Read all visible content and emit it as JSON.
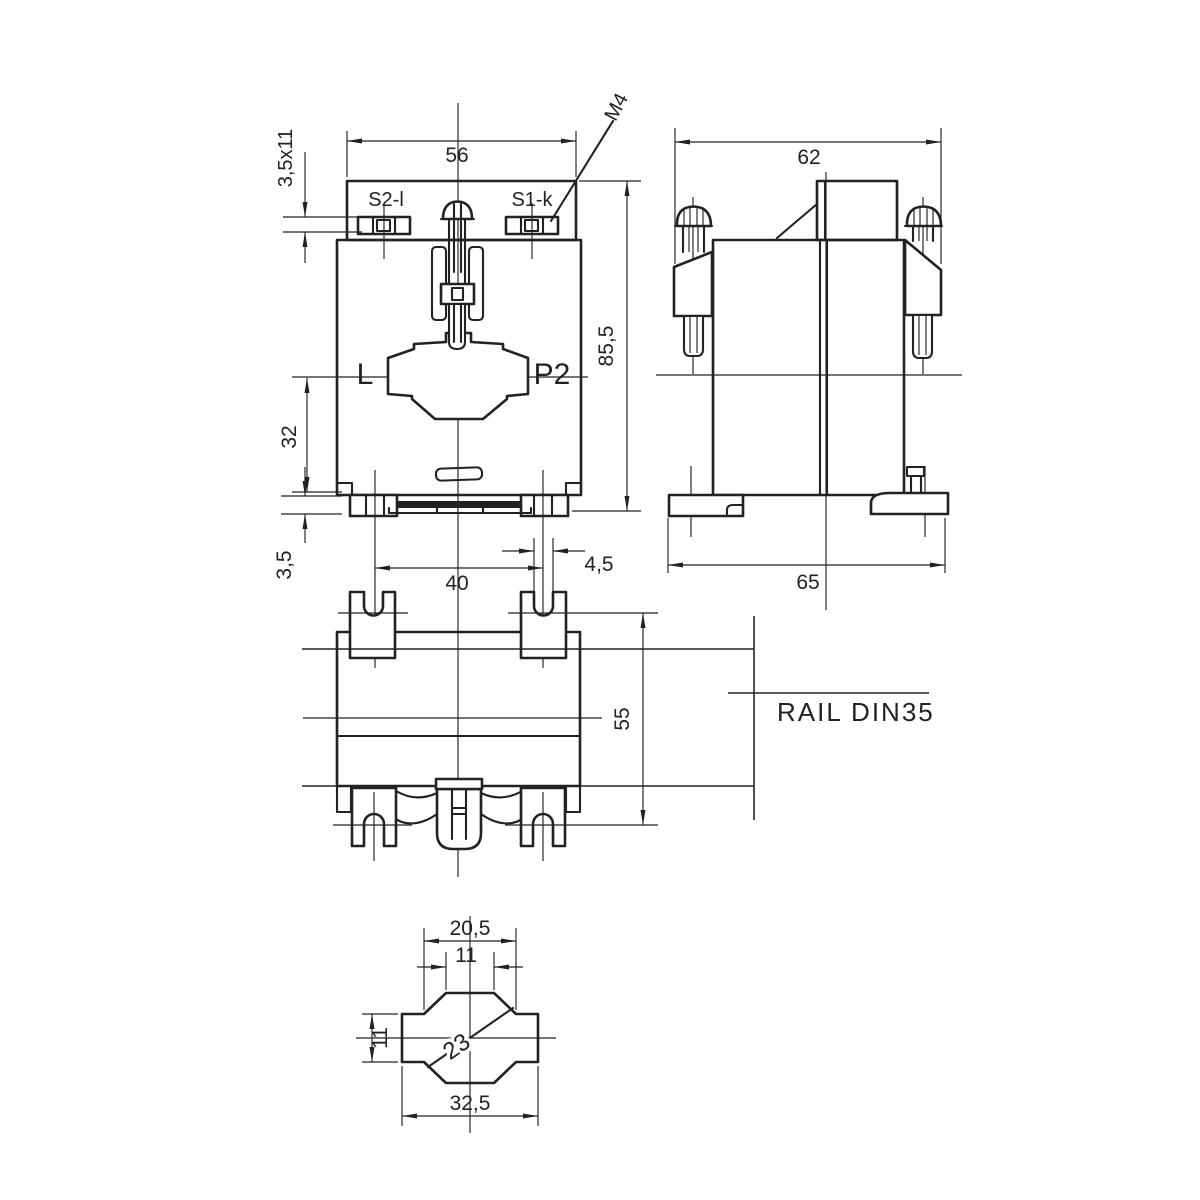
{
  "front_view": {
    "dim_plate_width": "56",
    "dim_terminal_slot": "3,5x11",
    "terminal_left_label": "S2-l",
    "terminal_right_label": "S1-k",
    "screw_thread_label": "M4",
    "dim_overall_height": "85,5",
    "primary_left_label": "L",
    "primary_right_label": "P2",
    "dim_center_to_base": "32",
    "dim_foot_height": "3,5",
    "dim_mounting_hole_spacing": "40",
    "dim_foot_slot_width": "4,5"
  },
  "side_view": {
    "dim_width_over_screws": "62",
    "dim_base_width": "65"
  },
  "plan_view": {
    "dim_depth": "55",
    "rail_label": "RAIL DIN35"
  },
  "aperture_view": {
    "dim_window_width": "20,5",
    "dim_window_inner_width": "11",
    "dim_bar_height": "11",
    "dim_diagonal": "23",
    "dim_overall_width": "32,5"
  },
  "colors": {
    "line": "#222222",
    "background": "#ffffff"
  }
}
